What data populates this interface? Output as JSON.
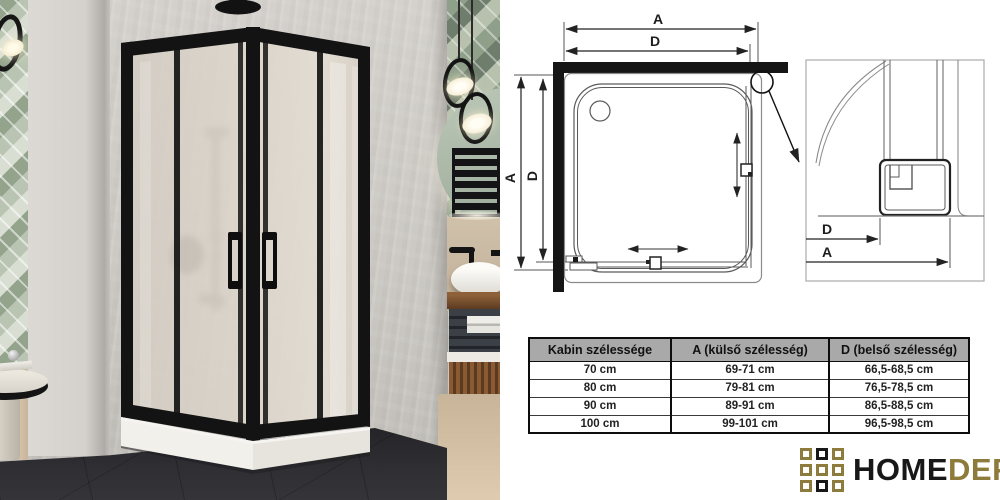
{
  "diagram": {
    "top_outer_label": "A",
    "top_inner_label": "D",
    "left_outer_label": "A",
    "left_inner_label": "D",
    "detail_inner_label": "D",
    "detail_outer_label": "A"
  },
  "table": {
    "headers": {
      "cabin": "Kabin szélessége",
      "outer": "A (külső szélesség)",
      "inner": "D (belső szélesség)"
    },
    "rows": [
      {
        "cabin": "70 cm",
        "outer": "69-71 cm",
        "inner": "66,5-68,5 cm"
      },
      {
        "cabin": "80 cm",
        "outer": "79-81 cm",
        "inner": "76,5-78,5 cm"
      },
      {
        "cabin": "90 cm",
        "outer": "89-91 cm",
        "inner": "86,5-88,5 cm"
      },
      {
        "cabin": "100 cm",
        "outer": "99-101 cm",
        "inner": "96,5-98,5 cm"
      }
    ]
  },
  "logo": {
    "word_primary": "HOME",
    "word_secondary": "DEPO",
    "color_gold": "#8d7b3b",
    "color_black": "#181818"
  }
}
